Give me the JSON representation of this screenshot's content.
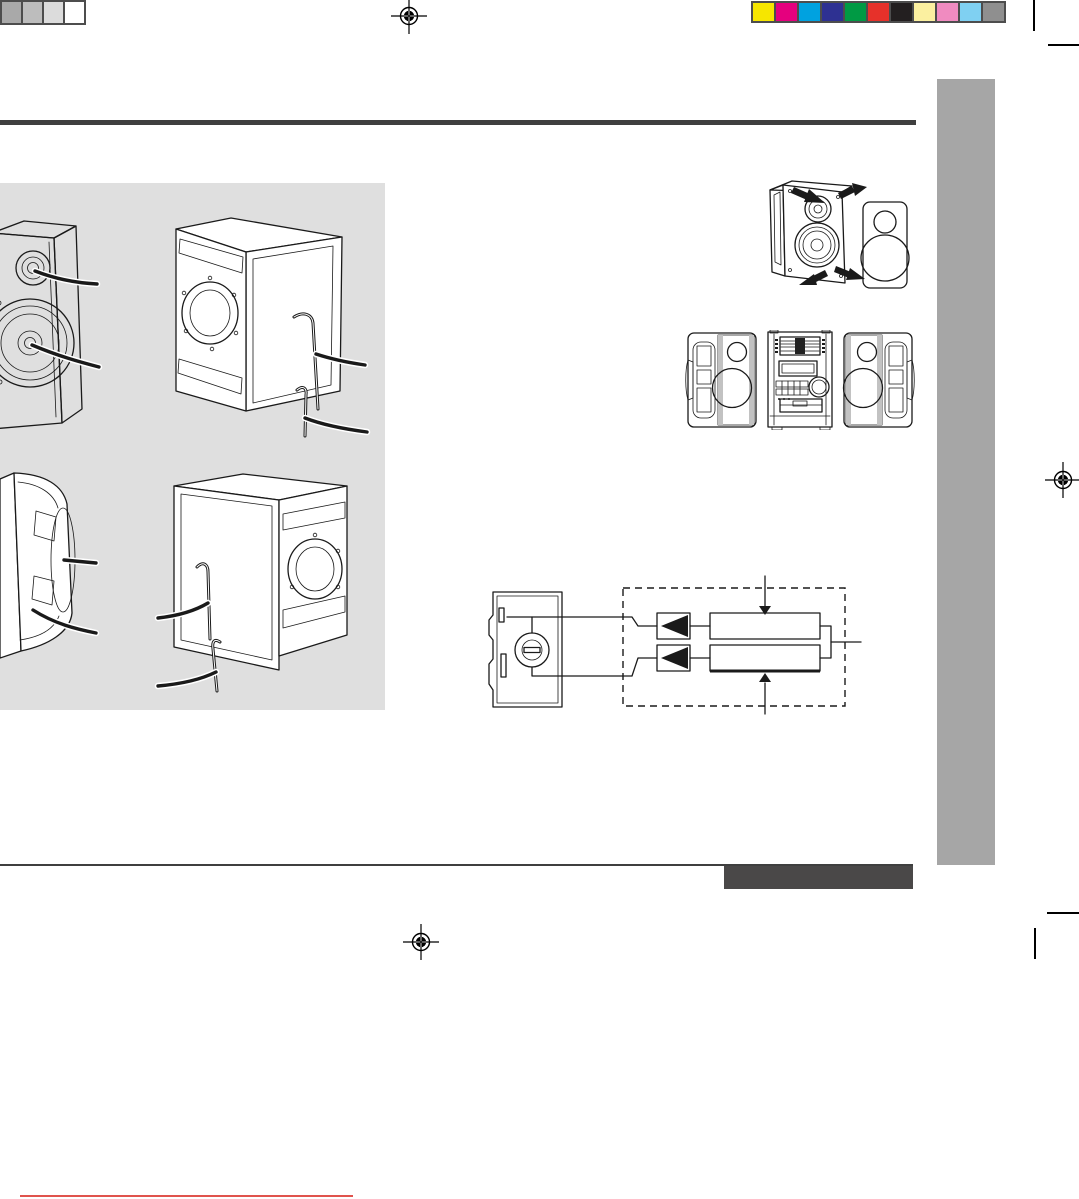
{
  "page": {
    "width": 1079,
    "height": 1199,
    "background": "#ffffff",
    "description": "Printed audio-system manual page proof; illustrations only, no rendered text"
  },
  "colors": {
    "header_rule": "#3f3f3f",
    "footer_rule": "#3f3f3f",
    "footer_bar": "#4a4848",
    "sidebar_tab": "#a6a6a6",
    "illustration_panel": "#dfdfdf",
    "red_underline": "#e0534d",
    "line_art": "#1a1a1a",
    "swatch_border": "#4d4d4d",
    "registration_mark": "#000000",
    "crop_mark": "#000000"
  },
  "prepress": {
    "grayscale_bar": {
      "colors": [
        "#a9a9a9",
        "#bdbdbd",
        "#dcdcdc",
        "#ffffff"
      ]
    },
    "color_bar": {
      "colors": [
        "#f6e600",
        "#e5007e",
        "#00a2e0",
        "#2e3192",
        "#009a44",
        "#e6312a",
        "#231f20",
        "#fbf0a0",
        "#f08bc0",
        "#7fd0f2",
        "#8f8f8f"
      ]
    }
  },
  "illustrations": [
    {
      "name": "speaker-front-view",
      "area": "panel top-left"
    },
    {
      "name": "speaker-cabinet-perspective-left",
      "area": "panel top-right"
    },
    {
      "name": "speaker-side-view",
      "area": "panel bottom-left"
    },
    {
      "name": "speaker-cabinet-perspective-right",
      "area": "panel bottom-right"
    },
    {
      "name": "grille-attach-detach",
      "area": "page top-right"
    },
    {
      "name": "system-front-three-units",
      "area": "page middle-right"
    },
    {
      "name": "speaker-wiring-crossover-diagram",
      "area": "page center"
    }
  ]
}
